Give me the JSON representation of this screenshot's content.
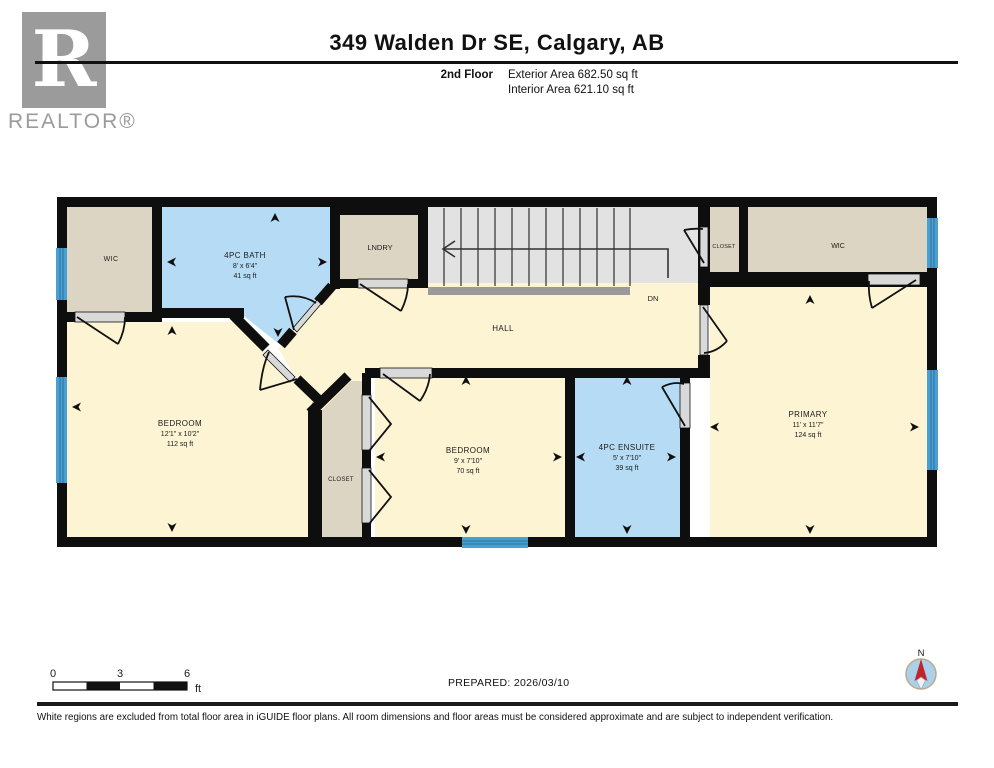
{
  "header": {
    "logo": {
      "letter": "R",
      "caption": "REALTOR®"
    },
    "title": "349 Walden Dr SE, Calgary, AB",
    "floor": "2nd Floor",
    "exterior": "Exterior Area 682.50 sq ft",
    "interior": "Interior Area 621.10 sq ft"
  },
  "plan": {
    "rooms": {
      "wic_tl": {
        "name": "WIC"
      },
      "bath": {
        "name": "4PC BATH",
        "dims": "8' x 6'4\"",
        "area": "41 sq ft"
      },
      "lndry": {
        "name": "LNDRY"
      },
      "closet_tr": {
        "name": "CLOSET"
      },
      "wic_tr": {
        "name": "WIC"
      },
      "hall": {
        "name": "HALL"
      },
      "bedroom_left": {
        "name": "BEDROOM",
        "dims": "12'1\" x 10'2\"",
        "area": "112 sq ft"
      },
      "closet_mid": {
        "name": "CLOSET"
      },
      "bedroom_mid": {
        "name": "BEDROOM",
        "dims": "9' x 7'10\"",
        "area": "70 sq ft"
      },
      "ensuite": {
        "name": "4PC ENSUITE",
        "dims": "5' x 7'10\"",
        "area": "39 sq ft"
      },
      "primary": {
        "name": "PRIMARY",
        "dims": "11' x 11'7\"",
        "area": "124 sq ft"
      }
    },
    "stairs": {
      "direction_label": "DN"
    }
  },
  "footer": {
    "scale": {
      "ticks": [
        "0",
        "3",
        "6"
      ],
      "unit": "ft"
    },
    "prepared": "PREPARED: 2026/03/10",
    "compass": "N",
    "disclaimer": "White regions are excluded from total floor area in iGUIDE floor plans. All room dimensions and floor areas must be considered approximate and are subject to independent verification."
  },
  "colors": {
    "room_beige": "#ddd5c3",
    "room_cream": "#fdf4d4",
    "room_blue": "#b5dcf4",
    "stairs_gray": "#e2e2e3",
    "stair_edge_gray": "#9a9a9a",
    "wall_black": "#0e0e0e",
    "window_blue": "#4a9fd2",
    "compass_blue": "#abd0ea",
    "compass_red": "#c3242a",
    "logo_gray": "#9b9b9b"
  }
}
